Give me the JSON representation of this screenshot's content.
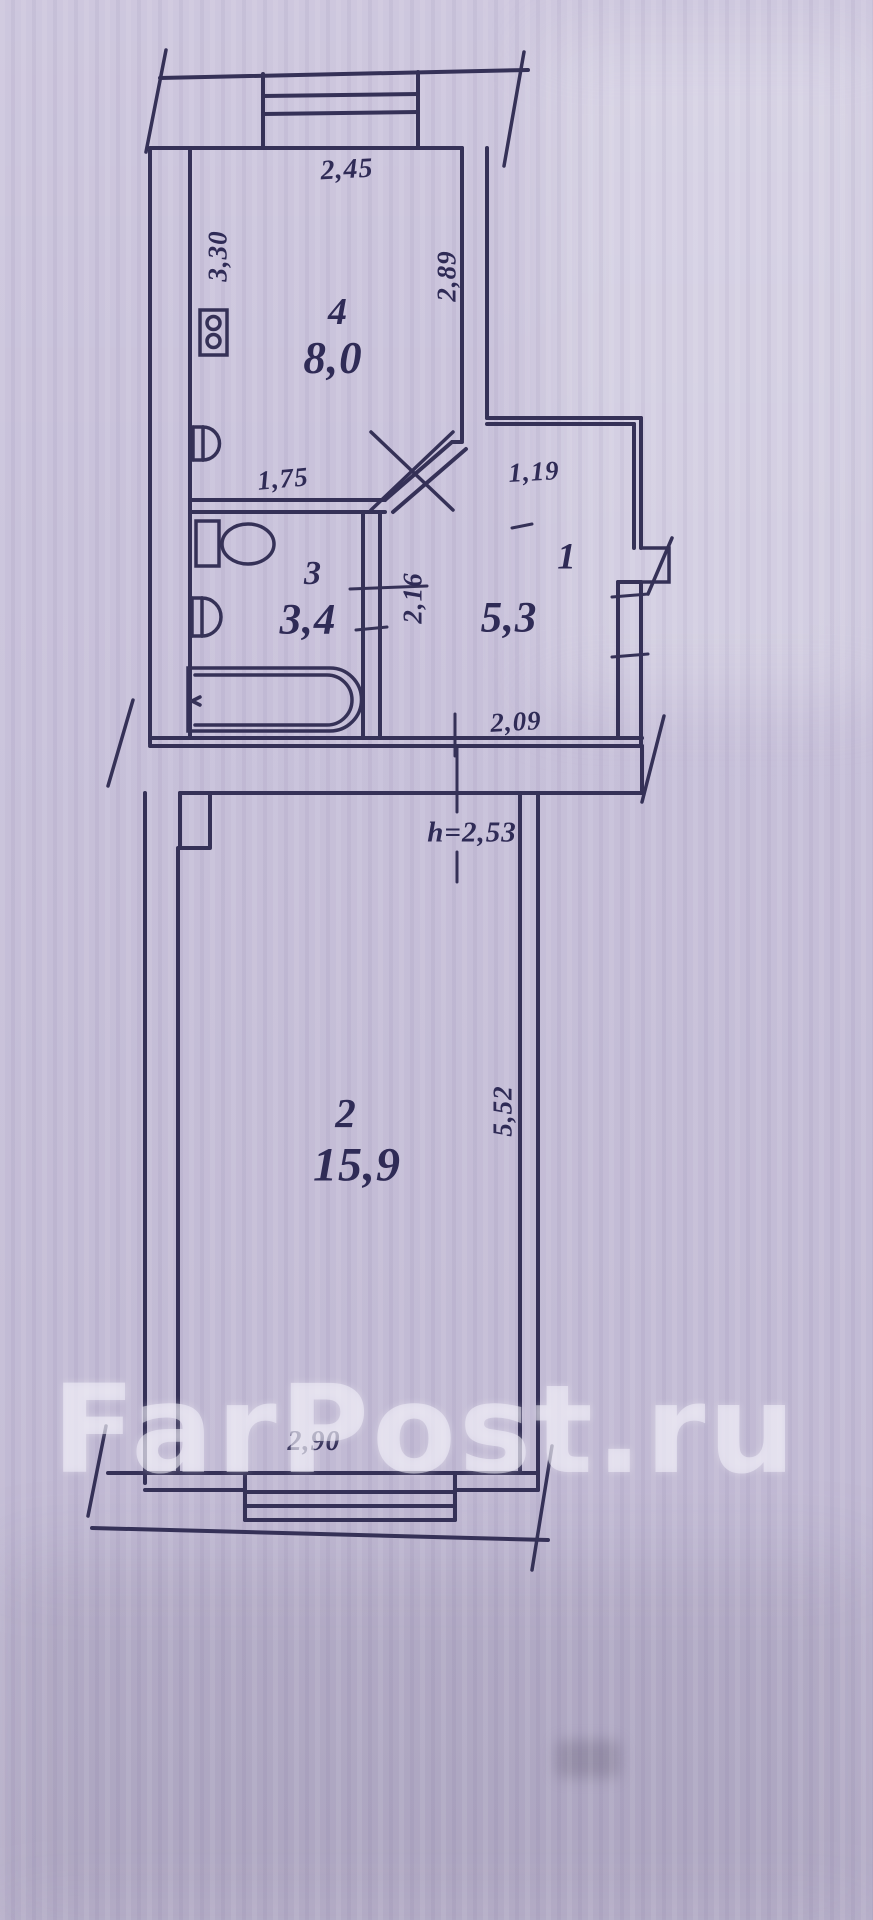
{
  "watermark": "FarPost.ru",
  "rooms": {
    "kitchen": {
      "number": "4",
      "area": "8,0"
    },
    "bathroom": {
      "number": "3",
      "area": "3,4"
    },
    "hallway": {
      "number": "1",
      "area": "5,3"
    },
    "living": {
      "number": "2",
      "area": "15,9"
    }
  },
  "dimensions": {
    "kitchen_width": "2,45",
    "kitchen_depth": "3,30",
    "kitchen_right_wall": "2,89",
    "bathroom_width": "1,75",
    "hallway_top": "1,19",
    "hallway_depth": "2,16",
    "hallway_bottom": "2,09",
    "ceiling_height": "h=2,53",
    "living_depth": "5,52",
    "living_window_width": "2,90"
  },
  "colors": {
    "paper": "#c8c1da",
    "ink": "#353157",
    "watermark": "rgba(243,241,250,0.55)"
  }
}
